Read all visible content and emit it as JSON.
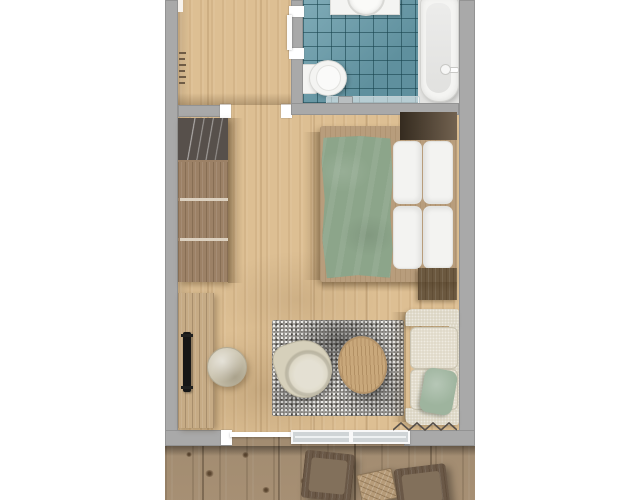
{
  "meta": {
    "kind": "3d-floor-plan-render",
    "view": "top-down",
    "text_on_screen": "none"
  },
  "palette": {
    "background": "#ffffff",
    "wall": "#a9a9a9",
    "door_frame": "#ffffff",
    "floor_wood": "#ddbf93",
    "bath_tile": "#6a9dab",
    "fixture_white": "#f4f4f2",
    "tub_niche": "#e3e3e1",
    "window_glass": "#cfd4d6",
    "wardrobe_wood": "#9c8166",
    "wardrobe_glass_panel": "#57504b",
    "desk_wood": "#c6ab85",
    "tv_black": "#161616",
    "stool_beige": "#cbc4af",
    "bed_frame_wood": "#b89d7c",
    "duvet_green": "#8ca58a",
    "bedding_white": "#f3f3f1",
    "nightstand_dark": "#5f4d38",
    "nightstand_dark2": "#6b583f",
    "rug_gray": "#a6a4a1",
    "armchair_beige": "#d6d0bb",
    "coffee_table_wood": "#c9a87b",
    "sofa_beige": "#dcd6c4",
    "sofa_cushion": "#e0dac9",
    "pillow_green": "#9eb49e",
    "deck_wood": "#b49b7d",
    "outdoor_dark_wood": "#6a5847",
    "outdoor_cushion": "#82705b",
    "patio_table_wood": "#b79c79"
  },
  "rooms": [
    {
      "id": "entrance-hall",
      "floor": "wood"
    },
    {
      "id": "bathroom",
      "floor": "teal-tile",
      "fixtures": [
        "washbasin-vanity",
        "toilet",
        "bathtub",
        "shower-glass-screen"
      ]
    },
    {
      "id": "living-bedroom",
      "floor": "wood",
      "furniture": [
        "wardrobe",
        "coat-hooks",
        "double-bed",
        "nightstand-top",
        "nightstand-bottom",
        "sideboard-desk",
        "tv",
        "stool",
        "rug",
        "armchair",
        "coffee-table",
        "sofa",
        "sofa-pillow"
      ]
    },
    {
      "id": "terrace",
      "floor": "weathered-deck",
      "furniture": [
        "lounge-chair-left",
        "patio-table",
        "lounge-chair-right"
      ]
    }
  ],
  "openings": [
    {
      "id": "bathroom-door",
      "between": [
        "entrance-hall",
        "bathroom"
      ],
      "state": "open"
    },
    {
      "id": "room-doorway",
      "between": [
        "entrance-hall",
        "living-bedroom"
      ],
      "state": "open"
    },
    {
      "id": "terrace-door",
      "between": [
        "living-bedroom",
        "terrace"
      ],
      "state": "open"
    },
    {
      "id": "south-window",
      "wall": "south",
      "panes": 2
    }
  ]
}
